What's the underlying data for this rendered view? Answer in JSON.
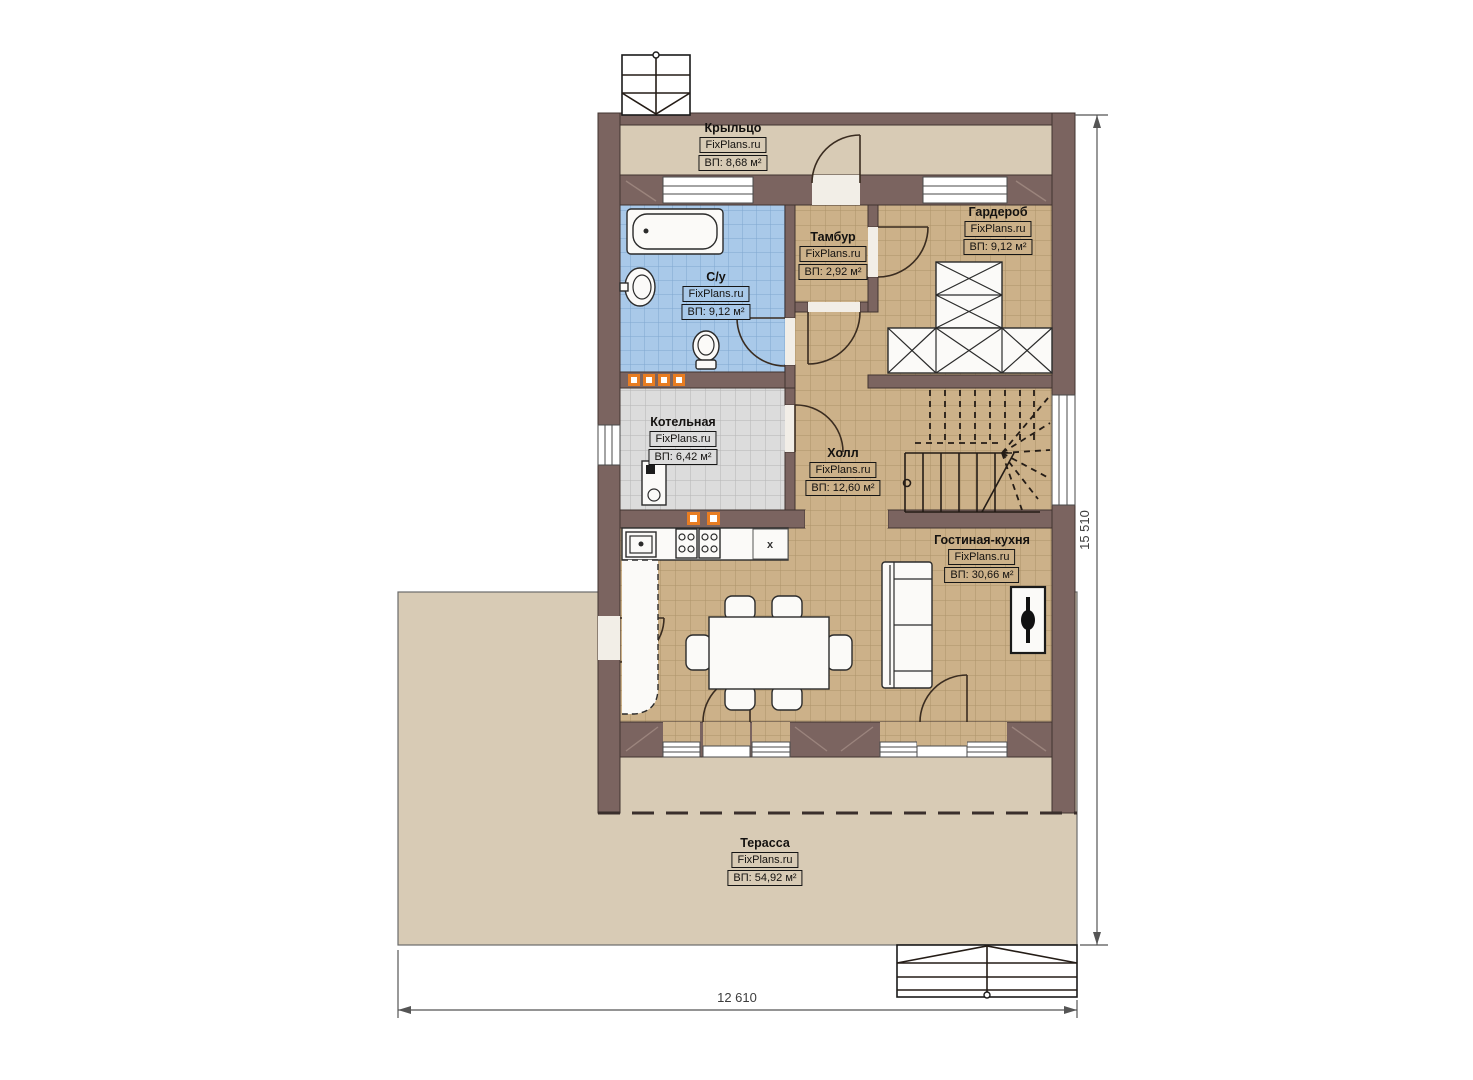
{
  "plan": {
    "brand": "FixPlans.ru",
    "rooms": [
      {
        "id": "porch",
        "name": "Крыльцо",
        "brand": "FixPlans.ru",
        "area": "ВП: 8,68 м²"
      },
      {
        "id": "bathroom",
        "name": "С/у",
        "brand": "FixPlans.ru",
        "area": "ВП: 9,12 м²"
      },
      {
        "id": "tambour",
        "name": "Тамбур",
        "brand": "FixPlans.ru",
        "area": "ВП: 2,92 м²"
      },
      {
        "id": "wardrobe",
        "name": "Гардероб",
        "brand": "FixPlans.ru",
        "area": "ВП: 9,12 м²"
      },
      {
        "id": "boiler",
        "name": "Котельная",
        "brand": "FixPlans.ru",
        "area": "ВП: 6,42 м²"
      },
      {
        "id": "hall",
        "name": "Холл",
        "brand": "FixPlans.ru",
        "area": "ВП: 12,60 м²"
      },
      {
        "id": "living_kitchen",
        "name": "Гостиная-кухня",
        "brand": "FixPlans.ru",
        "area": "ВП: 30,66 м²"
      },
      {
        "id": "terrace",
        "name": "Терасса",
        "brand": "FixPlans.ru",
        "area": "ВП: 54,92 м²"
      }
    ],
    "dimensions": {
      "height_mm": "15 510",
      "width_mm": "12 610"
    },
    "kitchen_marker": "x",
    "colors": {
      "wall": "#7b6460",
      "floor_tile": "#ccb189",
      "bathroom_tile": "#a9c9e9",
      "boiler_tile": "#dcdcdc",
      "terrace": "#d8cbb5",
      "accent_orange": "#e87d22"
    }
  }
}
